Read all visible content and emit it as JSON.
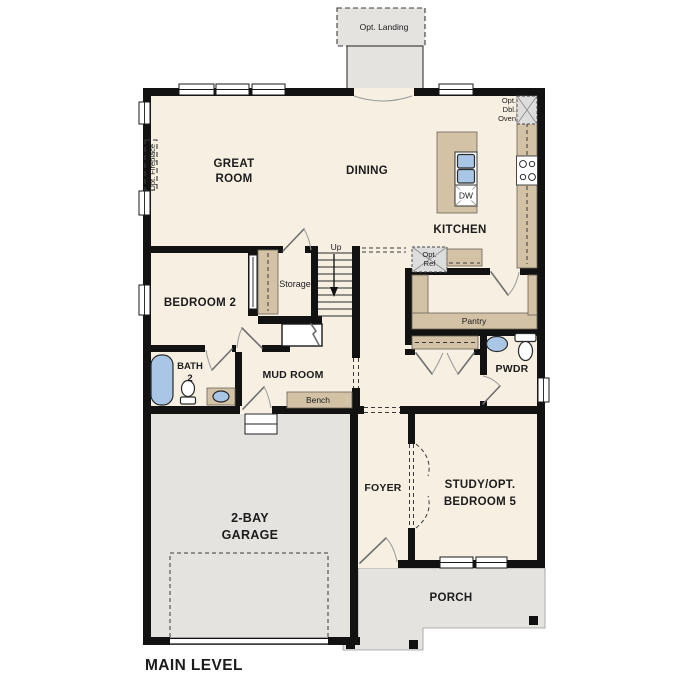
{
  "page_title": "MAIN LEVEL",
  "colors": {
    "floor": "#f6efe2",
    "garage": "#e4e3e0",
    "wall": "#121212",
    "cabinet": "#d3c2a6",
    "fixture_blue": "#a9c6e6",
    "appliance": "#dddddd",
    "door": "#6f6f6f"
  },
  "rooms": {
    "great_room": {
      "line1": "GREAT",
      "line2": "ROOM"
    },
    "dining": {
      "label": "DINING"
    },
    "kitchen": {
      "label": "KITCHEN"
    },
    "bedroom_2": {
      "label": "BEDROOM 2"
    },
    "bath_2": {
      "line1": "BATH",
      "line2": "2"
    },
    "mud_room": {
      "label": "MUD ROOM"
    },
    "storage": {
      "label": "Storage"
    },
    "pantry": {
      "label": "Pantry"
    },
    "powder_room": {
      "label": "PWDR"
    },
    "foyer": {
      "label": "FOYER"
    },
    "study": {
      "line1": "STUDY/OPT.",
      "line2": "BEDROOM 5"
    },
    "garage": {
      "line1": "2-BAY",
      "line2": "GARAGE"
    },
    "porch": {
      "label": "PORCH"
    }
  },
  "annotations": {
    "opt_landing": "Opt. Landing",
    "opt_fireplace": "Opt. Fireplace",
    "opt_dbl_oven_line1": "Opt.",
    "opt_dbl_oven_line2": "Dbl.",
    "opt_dbl_oven_line3": "Oven",
    "opt_ref_line1": "Opt.",
    "opt_ref_line2": "Ref",
    "dishwasher": "DW",
    "bench": "Bench",
    "stairs_direction": "Up"
  }
}
